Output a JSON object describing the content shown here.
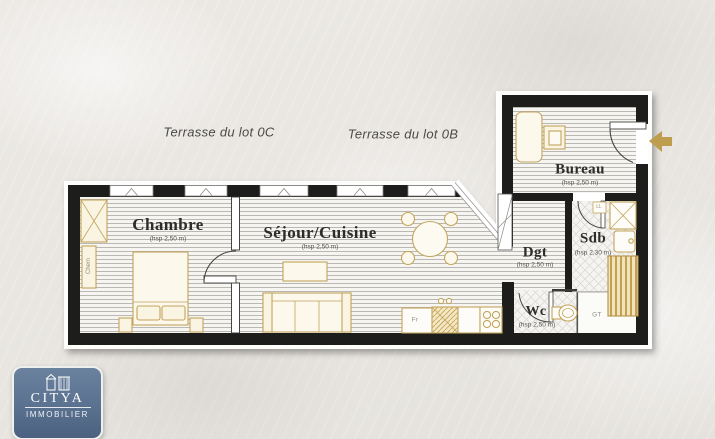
{
  "plan": {
    "terrace_labels": [
      {
        "label": "Terrasse du lot 0C"
      },
      {
        "label": "Terrasse du lot 0B"
      }
    ],
    "rooms": [
      {
        "name": "Chambre",
        "ceiling_height": "(hsp 2,50 m)"
      },
      {
        "name": "Séjour/Cuisine",
        "ceiling_height": "(hsp 2,50 m)"
      },
      {
        "name": "Bureau",
        "ceiling_height": "(hsp 2,50 m)"
      },
      {
        "name": "Sdb",
        "ceiling_height": "(hsp 2,30 m)"
      },
      {
        "name": "Dgt",
        "ceiling_height": "(hsp 2,50 m)"
      },
      {
        "name": "Wc",
        "ceiling_height": "(hsp 2,50 m)"
      }
    ],
    "annotations": {
      "technical_duct": "GT",
      "fridge": "Fr",
      "chimney": "Chem",
      "washing_machine": "LL"
    },
    "colors": {
      "wall": "#1d1d1b",
      "furniture_outline": "#c3a55c",
      "furniture_fill": "#faf4e3",
      "entry_arrow": "#bf9d4e",
      "room_label": "#2c2c2a",
      "terrace_label": "#4a4a48"
    }
  },
  "logo": {
    "brand": "CITYA",
    "tagline": "IMMOBILIER",
    "bg_top": "#6a829e",
    "bg_bottom": "#4b617f"
  }
}
